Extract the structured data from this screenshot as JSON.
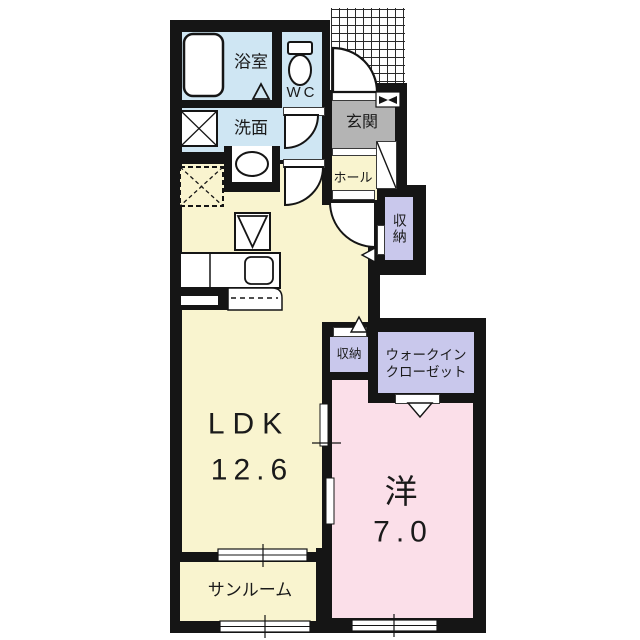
{
  "floor_plan": {
    "labels": {
      "bathroom": "浴室",
      "wc": "WC",
      "washroom": "洗面",
      "entrance": "玄関",
      "hall": "ホール",
      "storage_upper": "収納",
      "storage_lower": "収納",
      "wic_line1": "ウォークイン",
      "wic_line2": "クローゼット",
      "ldk_name": "LDK",
      "ldk_size": "12.6",
      "western_name": "洋",
      "western_size": "7.0",
      "sunroom": "サンルーム"
    },
    "colors": {
      "wall": "#151515",
      "wet_area": "#cfe6f3",
      "living_area": "#f9f4cf",
      "bedroom": "#fbdfe9",
      "storage": "#c9c8ec",
      "entrance": "#b4b4b4",
      "background": "#ffffff"
    }
  }
}
